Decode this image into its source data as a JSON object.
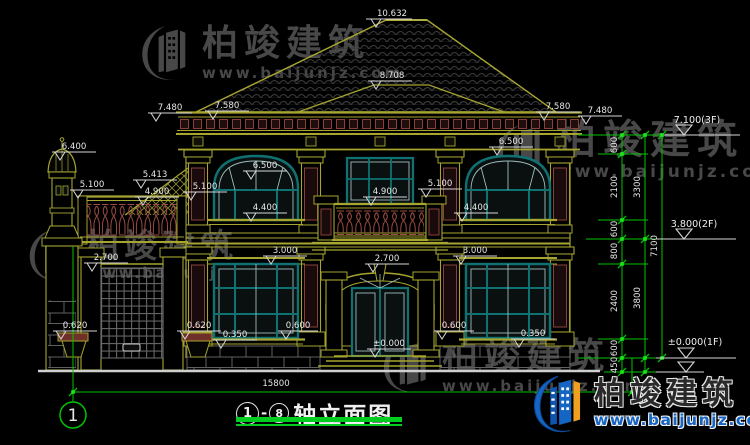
{
  "drawing": {
    "title": {
      "start_axis": "1",
      "end_axis": "8",
      "separator": "-",
      "name": "轴立面图"
    },
    "axis_bubble_left": "1",
    "total_width_dim": "15800",
    "elevations": {
      "ridge": "10.632",
      "upper_hip": "8.708",
      "eave_left": "7.480",
      "roof_left": "7.580",
      "roof_right": "7.580",
      "eave_right": "7.480",
      "floor3": "7.100(3F)",
      "floor2": "3.800(2F)",
      "floor1": "±0.000(1F)",
      "turret": "6.400",
      "annex_parapet": "5.100",
      "annex_roof_high": "5.413",
      "annex_roof_low": "4.900",
      "wall_parapet": "5.100",
      "balcony_rail": "4.900",
      "balcony_pier": "5.100",
      "window2_top_left": "6.500",
      "window2_top_right": "6.500",
      "window2_sill_left": "4.400",
      "window2_sill_right": "4.400",
      "window1_top_left": "3.000",
      "window1_top_right": "3.000",
      "gate_screen_top": "2.700",
      "entry_arch_top": "2.700",
      "planter_left": "0.620",
      "planter_right": "0.620",
      "plinth_left": "0.350",
      "plinth_right": "0.350",
      "door_side_left": "0.600",
      "door_side_right": "0.600",
      "ground": "±0.000"
    },
    "dim_chains": {
      "inner": [
        "600",
        "2100",
        "600",
        "800",
        "2400",
        "600",
        "450"
      ],
      "middle": [
        "3300",
        "3800"
      ],
      "overall": [
        "7100"
      ]
    }
  },
  "watermark": {
    "brand": "柏竣建筑",
    "url": "www.baijunjz.com"
  },
  "footer_logo": {
    "brand": "柏竣建筑",
    "url": "www.baijunjz.com"
  },
  "colors": {
    "cad_line": "#a5a52f",
    "dimension_green": "#00c300",
    "window_teal": "#0e7272",
    "detail_red": "#8a4038",
    "logo_blue": "#1565c5",
    "logo_orange": "#f0a020"
  }
}
